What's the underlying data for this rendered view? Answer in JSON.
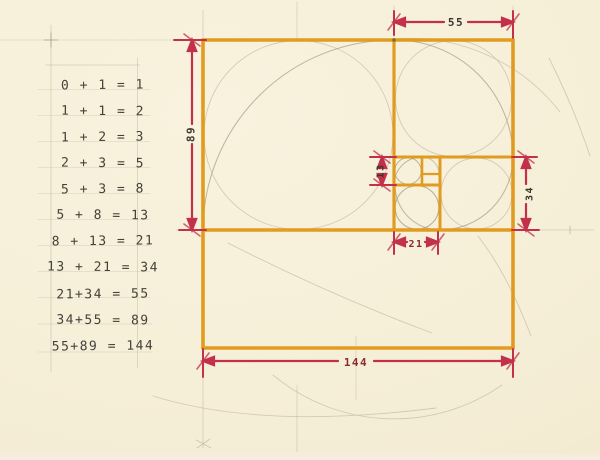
{
  "palette": {
    "paper": "#f6efd8",
    "crayon_orange": "#e19a1a",
    "crayon_red": "#c2304a",
    "pencil_grey": "#b2a88e",
    "ink": "#45403a",
    "dark_red_ink": "#8c2a34"
  },
  "equations": {
    "rows": [
      "0 + 1 = 1",
      "1 + 1 = 2",
      "1 + 2 = 3",
      "2 + 3 = 5",
      "5 + 3 = 8",
      "5 + 8 = 13",
      "8 + 13 = 21",
      "13 + 21 = 34",
      "21+34 = 55",
      "34+55 = 89",
      "55+89 = 144"
    ]
  },
  "diagram": {
    "dimensions": {
      "top_55": "55",
      "left_89": "89",
      "inner_13": "13",
      "right_34": "34",
      "inner_21": "21",
      "bottom_144": "144"
    }
  }
}
